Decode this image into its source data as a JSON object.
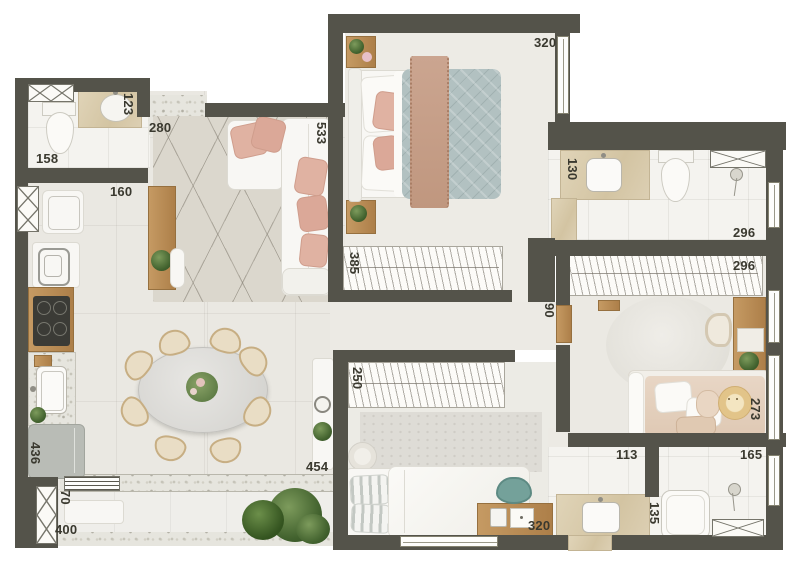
{
  "meta": {
    "description": "Top-down 3D rendered apartment floor plan with furniture and dimension labels (centimeters)"
  },
  "palette": {
    "wall": "#54534a",
    "floor_living": "#eae8e2",
    "floor_bath": "#f4f3ef",
    "terrazzo": "#e6e5de",
    "travertine": "#d8c9a8",
    "wood": "#c0945e",
    "duvet_teal": "#b2c1c1",
    "pillow_pink": "#e0b2a2",
    "chair_teal": "#74a19a",
    "plant_green": "#47682f",
    "label_text": "#3a392f"
  },
  "dims": {
    "master_bedroom": "320",
    "bath1_vanity": "123",
    "entry": "280",
    "living_sofa_wall": "533",
    "bath1_width": "158",
    "kitchen_passage": "160",
    "master_wardrobe": "385",
    "bath2_vanity": "130",
    "bath2_width": "296",
    "kids_wardrobe": "296",
    "hallway_width": "90",
    "bed3_wardrobe": "250",
    "kids_bed_wall": "273",
    "kitchen_run": "436",
    "bath3_vanity": "113",
    "bath3_shower": "165",
    "bath3_tub": "135",
    "bed3_desk_wall": "320",
    "balcony_door": "454",
    "balcony_depth": "70",
    "balcony_length": "400"
  }
}
